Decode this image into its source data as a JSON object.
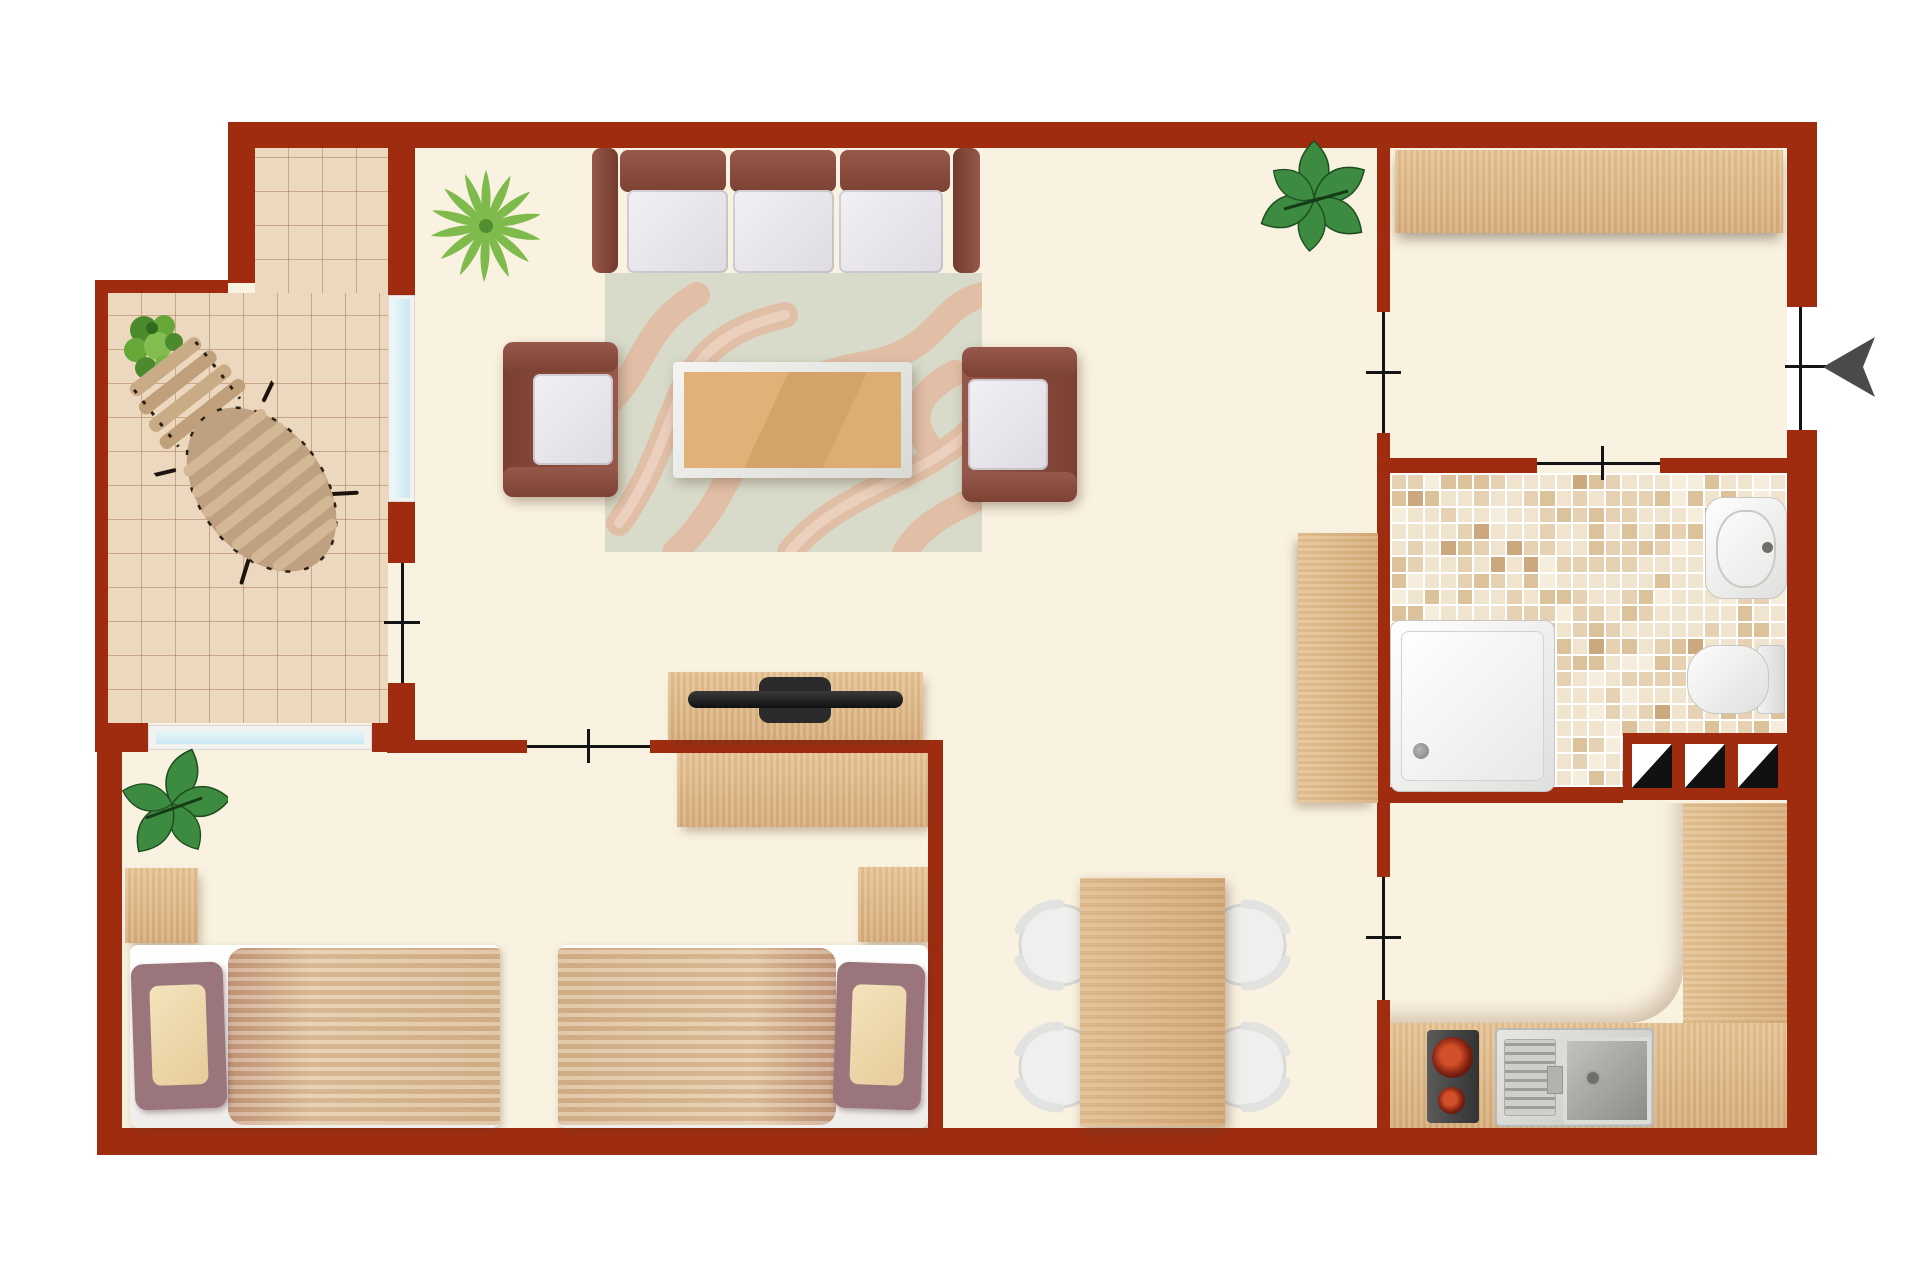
{
  "app": {
    "type": "floor-plan",
    "view": "top-down",
    "title_visible_text": ""
  },
  "palette": {
    "wall": "#A02C10",
    "floor": "#FAF2E1",
    "background": "#FFFFFF",
    "wood": "#D8AE7D",
    "wood2": "#E6C496",
    "tileBase": "#ECD8BE",
    "tileLine": "rgba(166,116,76,0.50)",
    "rugBase": "#D8DBCA",
    "rugSwirl": "#E2BCA4",
    "rugSwirlLight": "#ECD2C0",
    "sofaFrame": "#8B4F41",
    "sofaFrameDark": "#7B4032",
    "cushion": "#E9E6EB",
    "doorLine": "#141414",
    "arrow": "#4A4A4A",
    "plantGreen": "#46A04A",
    "plantPalm": "#7FBA4C",
    "stove": "#3F3F3F",
    "burner": "#C2401F"
  },
  "rooms": [
    {
      "name": "living-room",
      "furniture": [
        "three-seat-sofa",
        "armchair-left",
        "armchair-right",
        "coffee-table",
        "swirl-rug",
        "tv-sideboard",
        "potted-palm",
        "potted-plant-corner"
      ]
    },
    {
      "name": "balcony",
      "furniture": [
        "wicker-lounger",
        "potted-plant-balcony"
      ],
      "floor": "terracotta-tiles"
    },
    {
      "name": "bedroom",
      "furniture": [
        "single-bed-left",
        "single-bed-right",
        "nightstand-left",
        "nightstand-right",
        "wall-desk",
        "potted-plant-bedroom"
      ]
    },
    {
      "name": "hallway",
      "furniture": [
        "wardrobe-shelf"
      ]
    },
    {
      "name": "bathroom",
      "furniture": [
        "shower-tray",
        "washbasin",
        "toilet",
        "service-shaft-3"
      ],
      "floor": "beige-mosaic"
    },
    {
      "name": "kitchen",
      "furniture": [
        "l-shaped-counter",
        "two-burner-cooktop",
        "sink-with-drainer"
      ]
    },
    {
      "name": "dining-area",
      "furniture": [
        "dining-table",
        "dining-chair-x4",
        "tall-cabinet"
      ]
    }
  ],
  "doors": [
    {
      "between": "outside/hallway",
      "wall": "right",
      "marker": "line-tick",
      "extra": "entry-arrow-left"
    },
    {
      "between": "hallway/living-room",
      "marker": "line-tick"
    },
    {
      "between": "hallway/bathroom",
      "marker": "line-tick"
    },
    {
      "between": "dining-area/kitchen",
      "marker": "line-tick"
    },
    {
      "between": "living-room/bedroom",
      "marker": "line-tick"
    },
    {
      "between": "living-room/balcony",
      "marker": "line-tick"
    }
  ],
  "windows": [
    {
      "between": "balcony/living-room",
      "orientation": "vertical"
    },
    {
      "between": "bedroom/balcony",
      "orientation": "horizontal"
    }
  ],
  "bathroom_mosaic": {
    "cols": 24,
    "rows": 19,
    "colors": [
      "#F1E4CE",
      "#E6D2B2",
      "#DCC29B",
      "#F6EDDC",
      "#CBA87E"
    ],
    "weights": [
      0.46,
      0.22,
      0.16,
      0.1,
      0.06
    ]
  },
  "entry": {
    "arrow_direction": "left"
  }
}
